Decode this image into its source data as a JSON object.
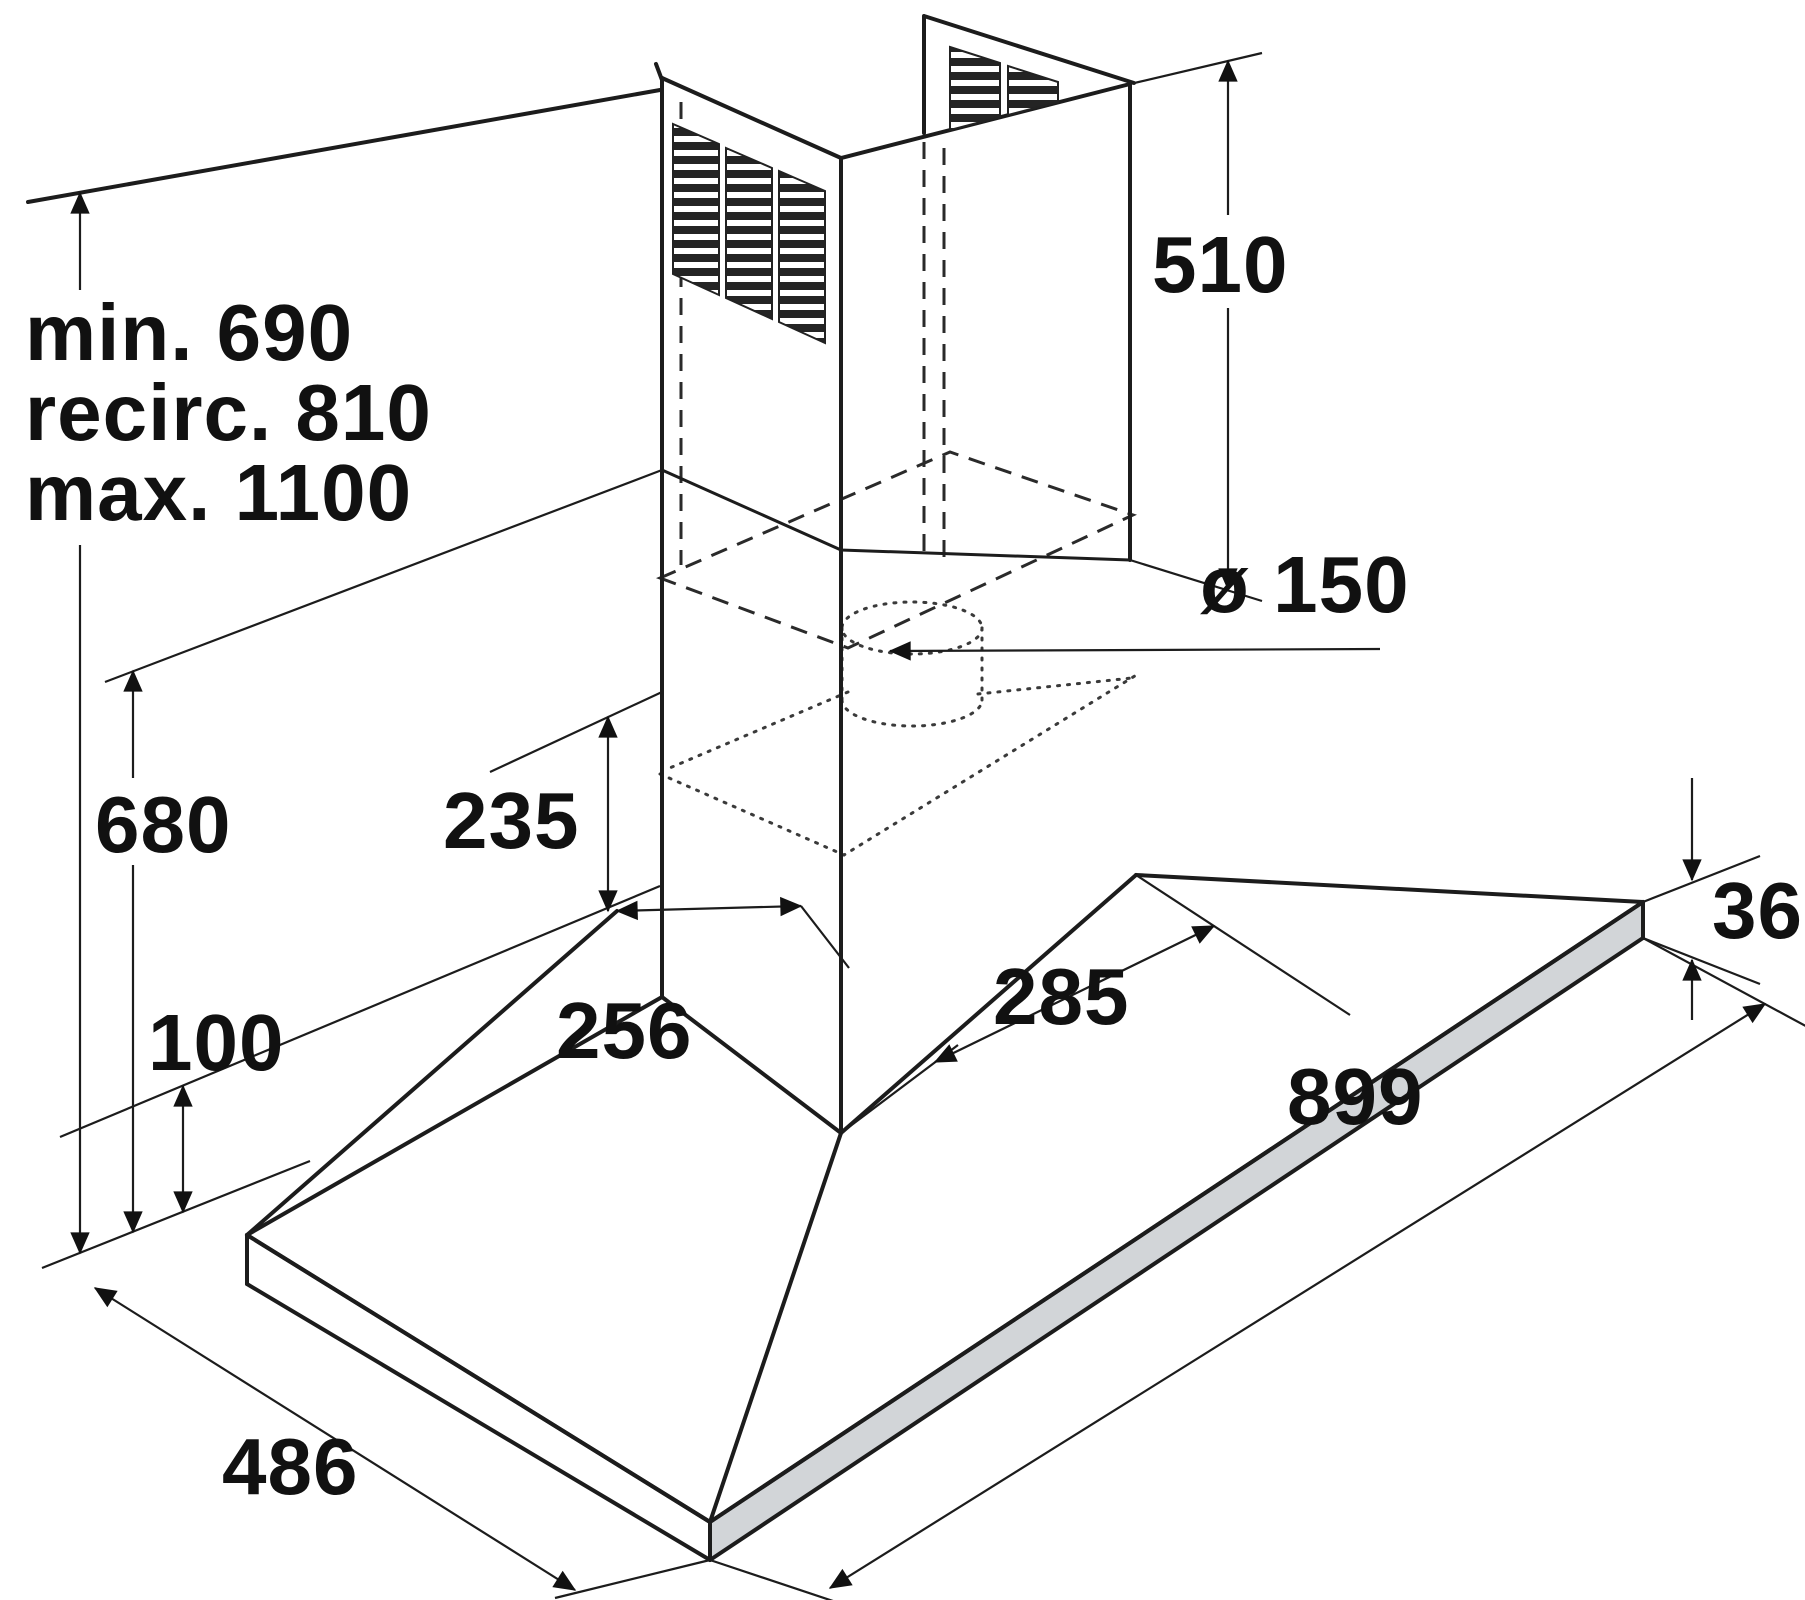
{
  "title": "Cooker hood installation dimension drawing",
  "units": "mm",
  "colors": {
    "line": "#1c1c1c",
    "shade": "#d2d5d8",
    "background": "#ffffff"
  },
  "dimensions": {
    "height_min": {
      "label": "min. 690"
    },
    "height_recirc": {
      "label": "recirc. 810"
    },
    "height_max": {
      "label": "max. 1100"
    },
    "chimney_upper_height": {
      "label": "510",
      "value": 510
    },
    "duct_diameter": {
      "label": "ø 150",
      "value": 150
    },
    "body_height": {
      "label": "680",
      "value": 680
    },
    "canopy_height": {
      "label": "235",
      "value": 235
    },
    "rear_offset": {
      "label": "100",
      "value": 100
    },
    "canopy_depth": {
      "label": "256",
      "value": 256
    },
    "canopy_width": {
      "label": "285",
      "value": 285
    },
    "base_thickness": {
      "label": "36",
      "value": 36
    },
    "base_width": {
      "label": "899",
      "value": 899
    },
    "base_depth": {
      "label": "486",
      "value": 486
    }
  }
}
